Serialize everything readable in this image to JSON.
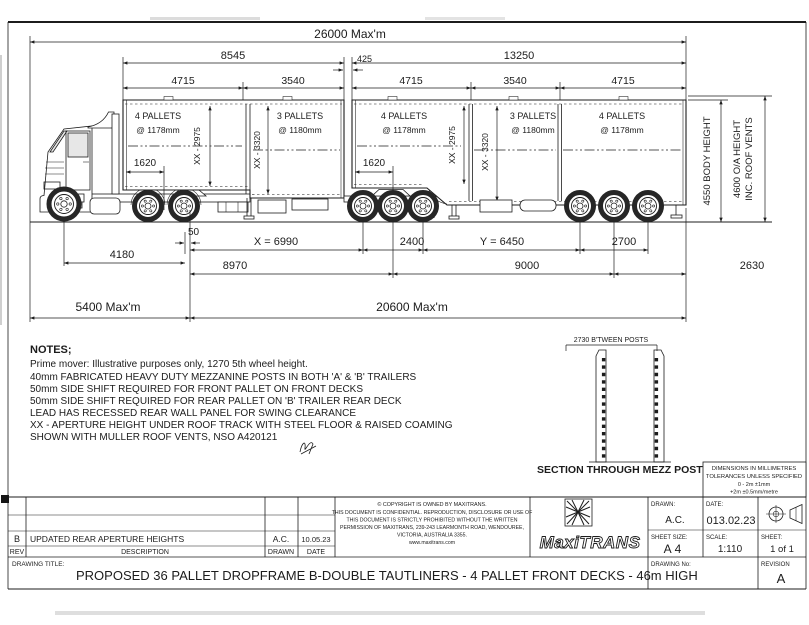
{
  "sheet": {
    "top_dims": {
      "overall": "26000 Max'm",
      "a_overall": "8545",
      "gap": "425",
      "b_overall": "13250",
      "deck_dims": [
        "4715",
        "3540",
        "4715",
        "3540",
        "4715"
      ]
    },
    "decks": [
      {
        "pallets": "4 PALLETS",
        "pitch": "@ 1178mm"
      },
      {
        "pallets": "3 PALLETS",
        "pitch": "@ 1180mm"
      },
      {
        "pallets": "4 PALLETS",
        "pitch": "@ 1178mm"
      },
      {
        "pallets": "3 PALLETS",
        "pitch": "@ 1180mm"
      },
      {
        "pallets": "4 PALLETS",
        "pitch": "@ 1178mm"
      }
    ],
    "apertures": {
      "a_front": "XX - 2975",
      "a_rear": "XX - 3320",
      "b_front": "XX - 2975",
      "b_mid": "XX - 3320"
    },
    "offsets": {
      "a_front": "1620",
      "b_front": "1620"
    },
    "heights": {
      "body": "4550 BODY HEIGHT",
      "oa_line1": "4600 O/A HEIGHT",
      "oa_line2": "INC. ROOF VENTS"
    },
    "bottom_dims": {
      "d50": "50",
      "x": "X = 6990",
      "a_spread": "2400",
      "y": "Y = 6450",
      "b_spread": "2700",
      "wheelbase": "4180",
      "lead_span": "8970",
      "b_span": "9000",
      "rear_overhang": "2630",
      "front_max": "5400 Max'm",
      "combo_max": "20600 Max'm"
    }
  },
  "notes": {
    "heading": "NOTES;",
    "lines": [
      "Prime mover: Illustrative purposes only, 1270 5th wheel height.",
      "40mm FABRICATED HEAVY DUTY MEZZANINE POSTS IN BOTH 'A' & 'B' TRAILERS",
      "50mm SIDE SHIFT REQUIRED FOR FRONT PALLET ON FRONT DECKS",
      "50mm SIDE SHIFT REQUIRED FOR REAR PALLET ON 'B' TRAILER REAR DECK",
      "LEAD HAS RECESSED REAR WALL PANEL FOR SWING CLEARANCE",
      "XX - APERTURE HEIGHT UNDER ROOF TRACK WITH STEEL FLOOR & RAISED COAMING",
      "SHOWN WITH MULLER ROOF VENTS, NSO A420121"
    ]
  },
  "section_detail": {
    "dim": "2730 B'TWEEN POSTS",
    "caption": "SECTION THROUGH MEZZ POSTS"
  },
  "tolerances": {
    "lines": [
      "DIMENSIONS IN MILLIMETRES",
      "TOLERANCES UNLESS SPECIFIED",
      "0 - 2m ±1mm",
      "+2m ±0.5mm/metre"
    ]
  },
  "title_block": {
    "rev_table": {
      "header": {
        "rev": "REV",
        "description": "DESCRIPTION",
        "drawn": "DRAWN",
        "date": "DATE"
      },
      "entry": {
        "rev": "B",
        "description": "UPDATED REAR APERTURE HEIGHTS",
        "drawn": "A.C.",
        "date": "10.05.23"
      }
    },
    "copyright": {
      "lines": [
        "© COPYRIGHT IS OWNED BY MAXITRANS.",
        "THIS DOCUMENT IS CONFIDENTIAL. REPRODUCTION, DISCLOSURE OR USE OF",
        "THIS DOCUMENT IS STRICTLY PROHIBITED WITHOUT THE WRITTEN",
        "PERMISSION OF MAXITRANS, 239-243 LEARMONTH ROAD, WENDOUREE,",
        "VICTORIA, AUSTRALIA 3355.",
        "www.maxitrans.com"
      ]
    },
    "logo_text": "MaxiTRANS",
    "fields": {
      "drawn_label": "DRAWN:",
      "drawn": "A.C.",
      "date_label": "DATE:",
      "date": "013.02.23",
      "sheet_size_label": "SHEET SIZE:",
      "sheet_size": "A4",
      "scale_label": "SCALE:",
      "scale": "1:110",
      "sheet_label": "SHEET:",
      "sheet": "1 of 1",
      "drawing_no_label": "DRAWING No:",
      "revision_label": "REVISION",
      "revision": "A",
      "title_label": "DRAWING TITLE:",
      "title": "PROPOSED 36 PALLET DROPFRAME B-DOUBLE TAUTLINERS - 4 PALLET FRONT DECKS - 46m HIGH"
    }
  }
}
